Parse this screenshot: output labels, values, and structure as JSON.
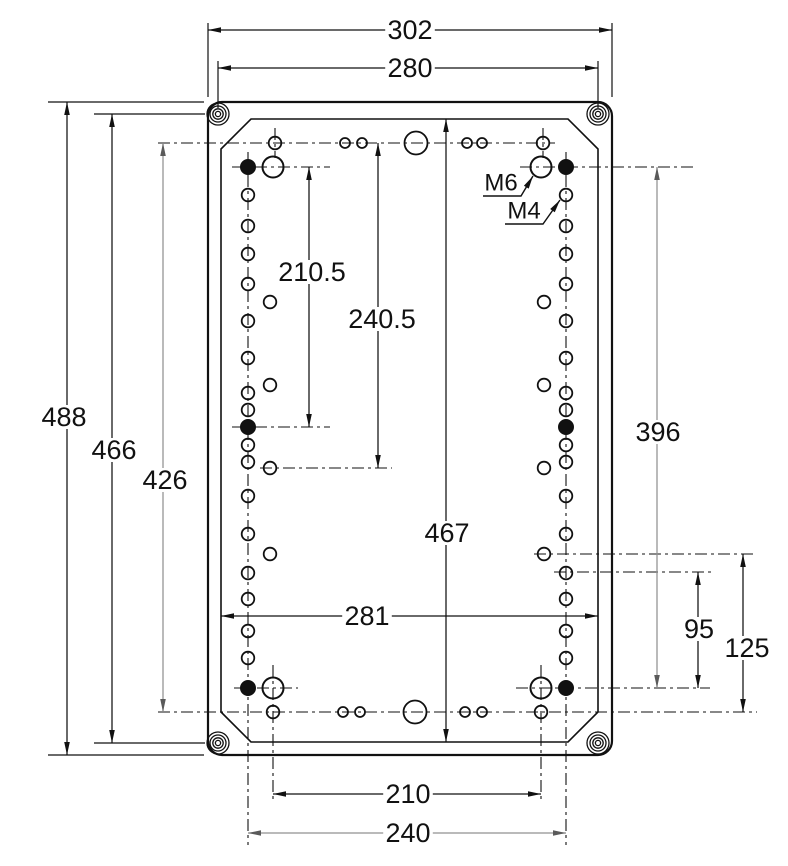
{
  "drawing": {
    "title": "mounting-plate-dimension-drawing",
    "canvas": {
      "w": 788,
      "h": 861,
      "bg": "#ffffff"
    },
    "colors": {
      "ink": "#111111",
      "gray": "#919191",
      "hole_fill": "#111111",
      "bg": "#ffffff"
    },
    "plate": {
      "outer": {
        "x": 208,
        "y": 102,
        "w": 404,
        "h": 653,
        "rx": 14
      },
      "inner": {
        "x1": 221,
        "y1": 119,
        "x2": 598,
        "y2": 742,
        "chamfer": 30
      },
      "screws": [
        [
          218,
          114
        ],
        [
          598,
          114
        ],
        [
          218,
          743
        ],
        [
          598,
          743
        ]
      ],
      "screw_radii": [
        11,
        8,
        5.2,
        2.6
      ]
    },
    "holes": {
      "column_x": [
        248,
        566
      ],
      "column_ys": [
        195,
        226,
        254,
        284,
        321,
        358,
        393,
        410,
        445,
        462,
        496,
        534,
        573,
        599,
        631,
        658
      ],
      "column_r": 6.3,
      "offset_x": [
        270,
        544
      ],
      "offset_ys": [
        302,
        385,
        468,
        554
      ],
      "offset_r": 6.3,
      "filled": [
        [
          248,
          167
        ],
        [
          566,
          167
        ],
        [
          248,
          427
        ],
        [
          566,
          427
        ],
        [
          248,
          688
        ],
        [
          566,
          688
        ]
      ],
      "filled_r": 7.5,
      "large": [
        [
          273,
          167
        ],
        [
          541,
          167
        ],
        [
          273,
          688
        ],
        [
          541,
          688
        ]
      ],
      "large_r": 10.5,
      "top_row": {
        "y": 143,
        "holes": [
          [
            275,
            6.3
          ],
          [
            345,
            5
          ],
          [
            362,
            5
          ],
          [
            416,
            11.5
          ],
          [
            467,
            5
          ],
          [
            482,
            5
          ],
          [
            543,
            6.3
          ]
        ]
      },
      "bottom_row": {
        "y": 712,
        "holes": [
          [
            273,
            6.3
          ],
          [
            343,
            5
          ],
          [
            360,
            5
          ],
          [
            415,
            11.5
          ],
          [
            465,
            5
          ],
          [
            482,
            5
          ],
          [
            541,
            6.3
          ]
        ]
      }
    },
    "centerlines": {
      "horizontal": [
        [
          158,
          143,
          555
        ],
        [
          232,
          167,
          330
        ],
        [
          520,
          167,
          695
        ],
        [
          232,
          427,
          330
        ],
        [
          260,
          468,
          392
        ],
        [
          534,
          554,
          757
        ],
        [
          554,
          572,
          712
        ],
        [
          234,
          688,
          298
        ],
        [
          516,
          688,
          710
        ],
        [
          158,
          712,
          757
        ]
      ],
      "vertical": [
        [
          248,
          152,
          845
        ],
        [
          566,
          152,
          845
        ],
        [
          273,
          665,
          803
        ],
        [
          541,
          665,
          803
        ],
        [
          275,
          128,
          158
        ],
        [
          543,
          128,
          158
        ]
      ]
    },
    "extension_lines": [
      [
        208,
        97,
        208,
        23
      ],
      [
        612,
        97,
        612,
        23
      ],
      [
        218,
        108,
        218,
        61
      ],
      [
        598,
        108,
        598,
        61
      ],
      [
        48,
        102,
        204,
        102
      ],
      [
        48,
        755,
        204,
        755
      ],
      [
        94,
        114,
        205,
        114
      ],
      [
        94,
        743,
        205,
        743
      ]
    ],
    "dimensions": [
      {
        "label": "302",
        "orient": "h",
        "pos": 30,
        "a": 208,
        "b": 612,
        "lx": 410,
        "ly": 30,
        "gray": false
      },
      {
        "label": "280",
        "orient": "h",
        "pos": 68,
        "a": 218,
        "b": 598,
        "lx": 410,
        "ly": 68,
        "gray": false
      },
      {
        "label": "488",
        "orient": "v",
        "pos": 67,
        "a": 102,
        "b": 755,
        "lx": 64,
        "ly": 417,
        "gray": false
      },
      {
        "label": "466",
        "orient": "v",
        "pos": 112,
        "a": 114,
        "b": 743,
        "lx": 114,
        "ly": 450,
        "gray": false
      },
      {
        "label": "426",
        "orient": "v",
        "pos": 163,
        "a": 143,
        "b": 712,
        "lx": 165,
        "ly": 480,
        "gray": true
      },
      {
        "label": "210.5",
        "orient": "v",
        "pos": 309,
        "a": 167,
        "b": 427,
        "lx": 312,
        "ly": 272,
        "gray": false
      },
      {
        "label": "240.5",
        "orient": "v",
        "pos": 378,
        "a": 143,
        "b": 468,
        "lx": 382,
        "ly": 319,
        "gray": false
      },
      {
        "label": "467",
        "orient": "v",
        "pos": 446,
        "a": 119,
        "b": 742,
        "lx": 447,
        "ly": 533,
        "gray": false
      },
      {
        "label": "396",
        "orient": "v",
        "pos": 657,
        "a": 167,
        "b": 688,
        "lx": 658,
        "ly": 432,
        "gray": true
      },
      {
        "label": "281",
        "orient": "h",
        "pos": 616,
        "a": 221,
        "b": 598,
        "lx": 367,
        "ly": 616,
        "gray": false
      },
      {
        "label": "95",
        "orient": "v",
        "pos": 698,
        "a": 572,
        "b": 688,
        "lx": 699,
        "ly": 629,
        "gray": false
      },
      {
        "label": "125",
        "orient": "v",
        "pos": 743,
        "a": 554,
        "b": 712,
        "lx": 747,
        "ly": 648,
        "gray": false
      },
      {
        "label": "210",
        "orient": "h",
        "pos": 794,
        "a": 273,
        "b": 541,
        "lx": 408,
        "ly": 794,
        "gray": false
      },
      {
        "label": "240",
        "orient": "h",
        "pos": 833,
        "a": 248,
        "b": 566,
        "lx": 408,
        "ly": 833,
        "gray": true
      }
    ],
    "leaders": [
      {
        "label": "M6",
        "tx": 501,
        "ty": 183,
        "points": [
          [
            483,
            196
          ],
          [
            521,
            196
          ],
          [
            533,
            176
          ]
        ]
      },
      {
        "label": "M4",
        "tx": 524,
        "ty": 211,
        "points": [
          [
            505,
            224
          ],
          [
            543,
            224
          ],
          [
            560,
            200
          ]
        ]
      }
    ]
  }
}
